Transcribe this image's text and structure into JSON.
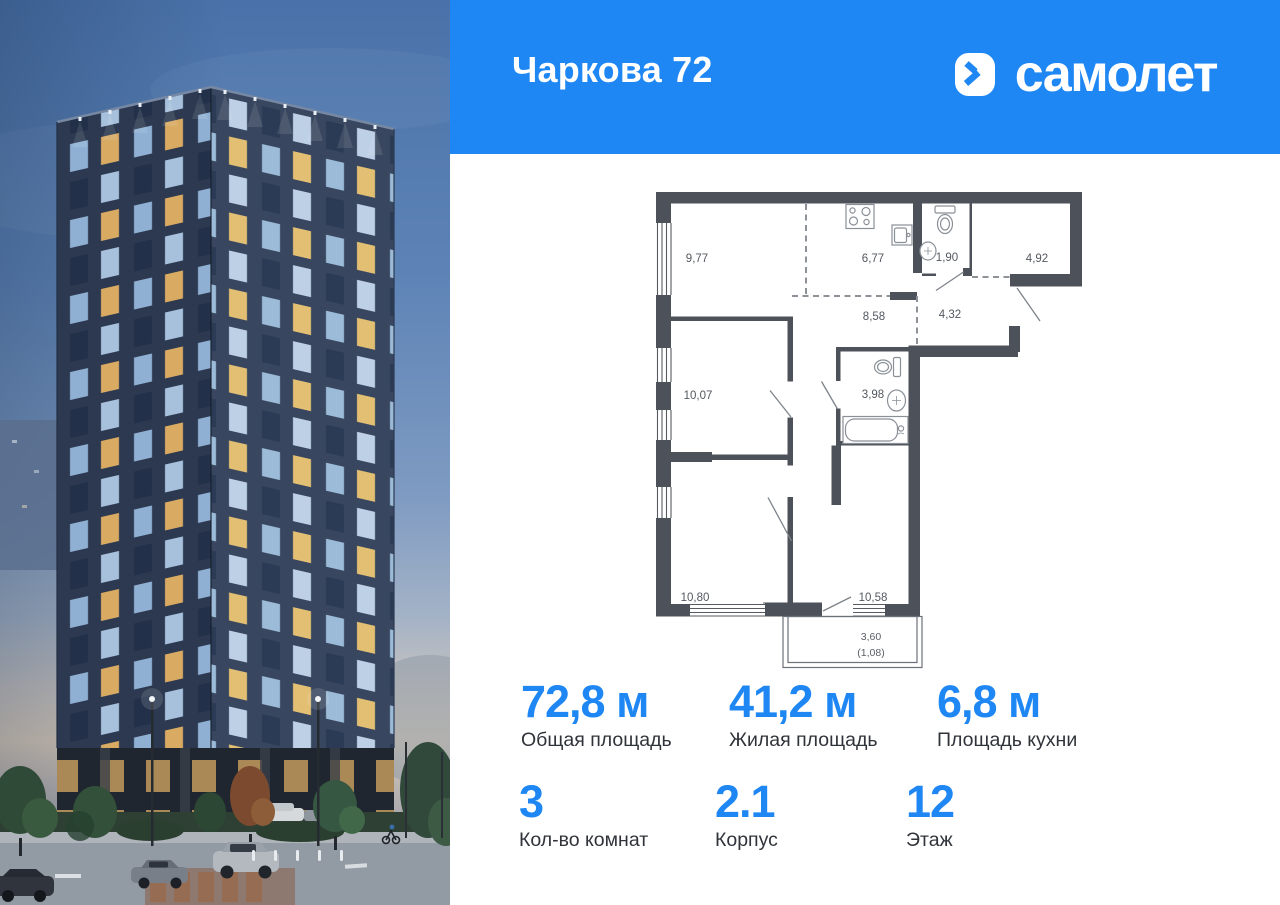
{
  "header": {
    "title": "Чаркова 72",
    "brand": "самолет"
  },
  "plan": {
    "rooms": [
      {
        "name": "bedroom-top",
        "area": "9,77"
      },
      {
        "name": "kitchen",
        "area": "6,77"
      },
      {
        "name": "wc",
        "area": "1,90"
      },
      {
        "name": "entry-hall",
        "area": "4,92"
      },
      {
        "name": "corridor",
        "area": "8,58"
      },
      {
        "name": "hall",
        "area": "4,32"
      },
      {
        "name": "bedroom-middle",
        "area": "10,07"
      },
      {
        "name": "bathroom",
        "area": "3,98"
      },
      {
        "name": "bedroom-bottom",
        "area": "10,80"
      },
      {
        "name": "living-room",
        "area": "10,58"
      }
    ],
    "balcony": {
      "area": "3,60",
      "reduced": "(1,08)"
    }
  },
  "stats": [
    {
      "value": "72,8 м",
      "label": "Общая площадь"
    },
    {
      "value": "41,2 м",
      "label": "Жилая площадь"
    },
    {
      "value": "6,8 м",
      "label": "Площадь кухни"
    },
    {
      "value": "3",
      "label": "Кол-во комнат"
    },
    {
      "value": "2.1",
      "label": "Корпус"
    },
    {
      "value": "12",
      "label": "Этаж"
    }
  ],
  "colors": {
    "accent": "#1f87f4",
    "wall": "#4d525a"
  }
}
